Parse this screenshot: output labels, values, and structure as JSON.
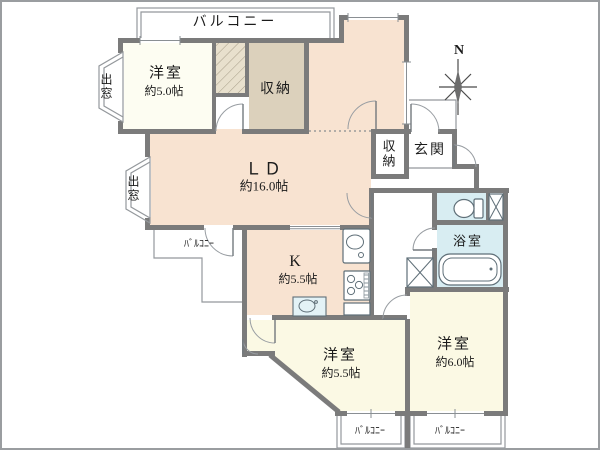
{
  "colors": {
    "wall": "#7b7b7b",
    "thin": "#94989c",
    "peach": "#f8e3d1",
    "cream": "#fbf9e4",
    "cream_light": "#fdfdf2",
    "tan": "#dcd1bc",
    "closet_tan": "#e8e0cd",
    "wet_blue": "#d8edf2",
    "fixstroke": "#5f6f78"
  },
  "compass": {
    "north": "N"
  },
  "balconies": {
    "top": "バルコニー",
    "ld": "ﾊﾞﾙｺﾆｰ",
    "south_left": "ﾊﾞﾙｺﾆｰ",
    "south_right": "ﾊﾞﾙｺﾆｰ"
  },
  "bay_windows": {
    "north": "出窓",
    "west": "出窓"
  },
  "rooms": {
    "bedroom_nw": {
      "name": "洋室",
      "size": "約5.0帖"
    },
    "storage_north": {
      "name": "収納"
    },
    "living_dining": {
      "name": "ＬＤ",
      "size": "約16.0帖"
    },
    "storage_hall": {
      "name": "収納"
    },
    "entrance": {
      "name": "玄関"
    },
    "kitchen": {
      "name": "K",
      "size": "約5.5帖"
    },
    "bathroom": {
      "name": "浴室"
    },
    "bedroom_south": {
      "name": "洋室",
      "size": "約5.5帖"
    },
    "bedroom_southeast": {
      "name": "洋室",
      "size": "約6.0帖"
    }
  }
}
